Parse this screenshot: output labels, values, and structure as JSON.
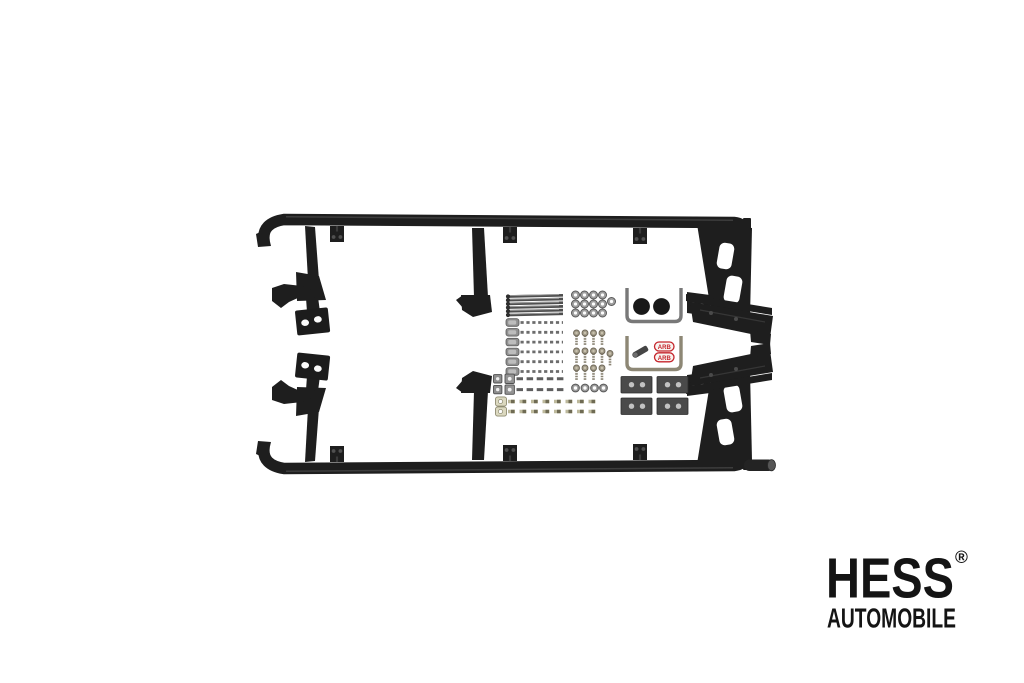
{
  "page": {
    "width": 1024,
    "height": 683,
    "background": "#ffffff"
  },
  "logo": {
    "brand": "HESS",
    "registered_mark": "®",
    "subtitle": "AUTOMOBILE",
    "color": "#141414"
  },
  "product": {
    "colors": {
      "rail_black": "#1e1e1e",
      "steel_gray": "#8f8f8f",
      "zinc_plated": "#d9d6bd",
      "bracket_plate_gray": "#4a4a4a",
      "rubber_cap_black": "#181818",
      "sticker_red": "#c5242b",
      "sticker_background": "#f8f4f0"
    },
    "stickers": [
      {
        "label": "ARB"
      },
      {
        "label": "ARB"
      }
    ]
  }
}
